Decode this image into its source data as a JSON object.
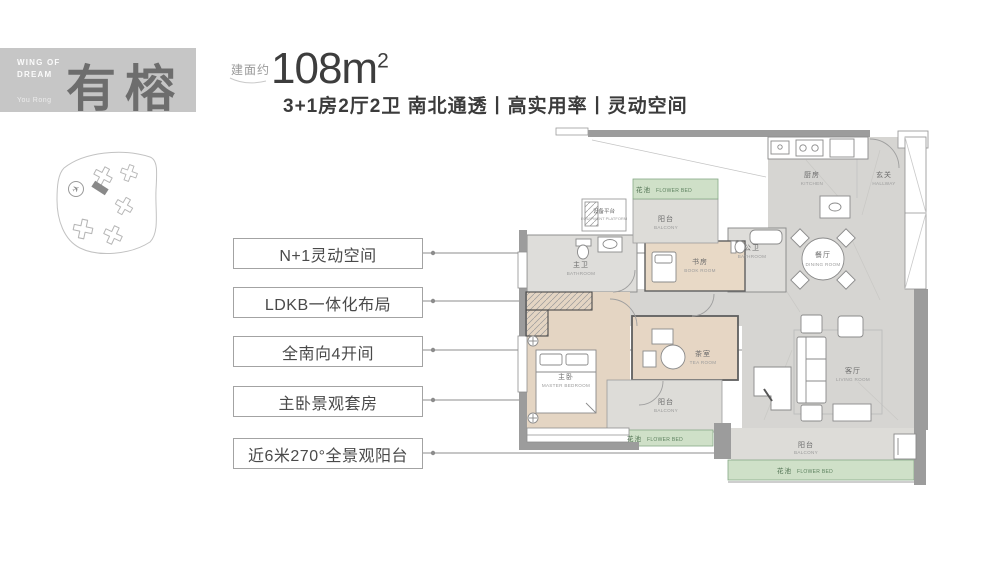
{
  "brand": {
    "tagline": "WING OF DREAM",
    "name_zh": "有榕",
    "name_en": "You Rong"
  },
  "header": {
    "area_prefix": "建面约",
    "area_value": "108m",
    "area_sup": "2",
    "subtitle": "3+1房2厅2卫 南北通透丨高实用率丨灵动空间"
  },
  "callouts": [
    {
      "label": "N+1灵动空间"
    },
    {
      "label": "LDKB一体化布局"
    },
    {
      "label": "全南向4开间"
    },
    {
      "label": "主卧景观套房"
    },
    {
      "label": "近6米270°全景观阳台"
    }
  ],
  "plan": {
    "rooms": [
      {
        "id": "flower-bed-top",
        "zh": "花池",
        "en": "FLOWER BED"
      },
      {
        "id": "balcony-top",
        "zh": "阳台",
        "en": "BALCONY"
      },
      {
        "id": "equipment-platform",
        "zh": "设备平台",
        "en": "EQUIPMENT PLATFORM"
      },
      {
        "id": "master-bathroom",
        "zh": "主卫",
        "en": "BATHROOM"
      },
      {
        "id": "book-room",
        "zh": "书房",
        "en": "BOOK ROOM"
      },
      {
        "id": "guest-bathroom",
        "zh": "公卫",
        "en": "BATHROOM"
      },
      {
        "id": "kitchen",
        "zh": "厨房",
        "en": "KITCHEN"
      },
      {
        "id": "hallway",
        "zh": "玄关",
        "en": "HALLWAY"
      },
      {
        "id": "dining-room",
        "zh": "餐厅",
        "en": "DINING ROOM"
      },
      {
        "id": "master-bedroom",
        "zh": "主卧",
        "en": "MASTER BEDROOM"
      },
      {
        "id": "tea-room",
        "zh": "茶室",
        "en": "TEA ROOM"
      },
      {
        "id": "living-room",
        "zh": "客厅",
        "en": "LIVING ROOM"
      },
      {
        "id": "balcony-mid",
        "zh": "阳台",
        "en": "BALCONY"
      },
      {
        "id": "flower-bed-mid",
        "zh": "花池",
        "en": "FLOWER BED"
      },
      {
        "id": "balcony-right",
        "zh": "阳台",
        "en": "BALCONY"
      },
      {
        "id": "flower-bed-right",
        "zh": "花池",
        "en": "FLOWER BED"
      }
    ]
  },
  "site_map": {
    "marker_icon": "plane-icon"
  },
  "colors": {
    "logo_bg": "#c6c6c6",
    "logo_text": "#6d6d6d",
    "title_text": "#3d3d3d",
    "wall": "#9c9c9c",
    "tile_floor": "#d6d5d2",
    "wood_floor": "#e4d5c3",
    "flower_bed": "#cfe0c8",
    "flower_text": "#4e7050",
    "leader": "#8c8c8c"
  }
}
